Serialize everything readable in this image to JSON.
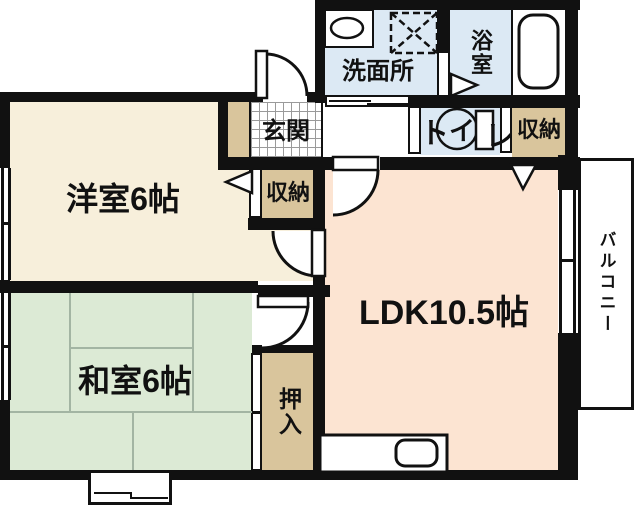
{
  "colors": {
    "wall": "#111111",
    "western": "#f7efdb",
    "tatami": "#dcead5",
    "tatami-line": "#a3b5a3",
    "ldk": "#fce4d2",
    "water": "#dce9f4",
    "storage": "#d9c59c",
    "tile-line": "#9a9a9a",
    "bg": "#ffffff"
  },
  "rooms": {
    "western": {
      "label": "洋室6帖"
    },
    "japanese": {
      "label": "和室6帖"
    },
    "ldk": {
      "label": "LDK10.5帖"
    },
    "entrance": {
      "label": "玄関"
    },
    "washroom": {
      "label": "洗面所"
    },
    "bathroom": {
      "label": "浴室"
    },
    "toilet": {
      "label": "トイレ",
      "part1": "ト",
      "part2": "イ",
      "part3": "レ"
    },
    "storage_western": {
      "label": "収納"
    },
    "storage_hall": {
      "label": "収納"
    },
    "closet": {
      "label": "押入"
    },
    "balcony": {
      "label": "バルコニー"
    }
  }
}
